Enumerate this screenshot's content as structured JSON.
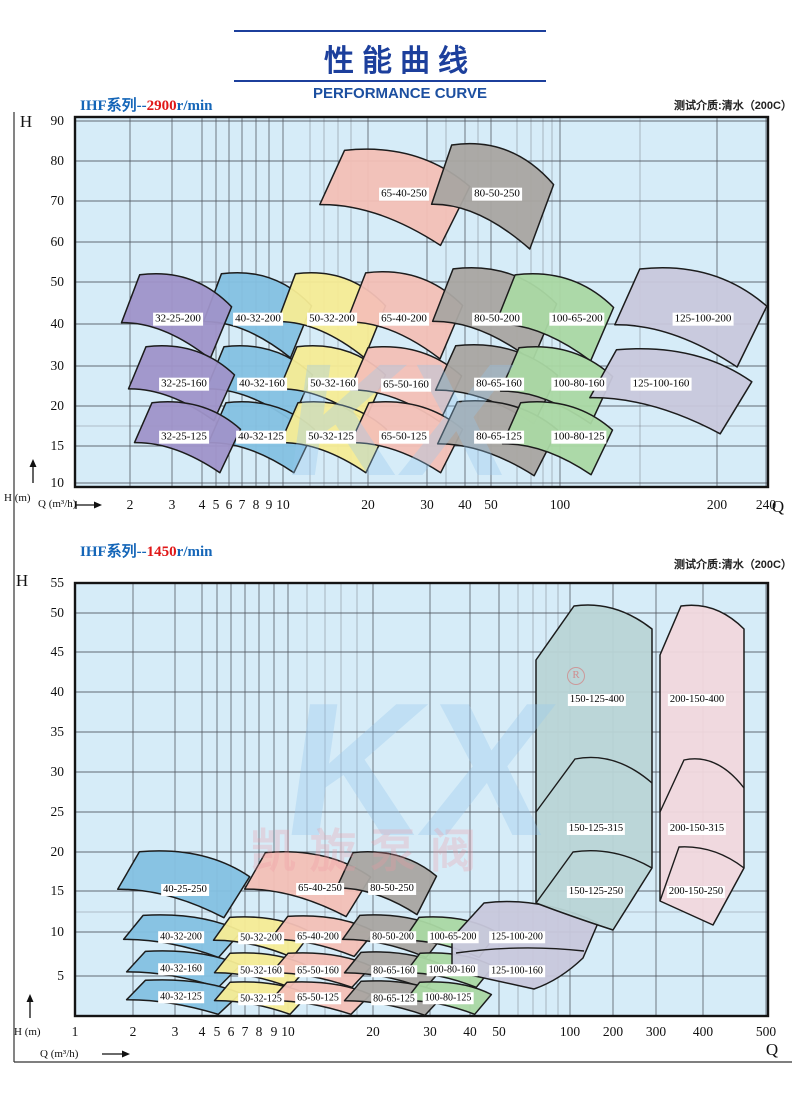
{
  "page": {
    "title_cn": "性能曲线",
    "title_en": "PERFORMANCE CURVE",
    "watermark": {
      "letters": "KX",
      "reg": "R",
      "cn": "凯旋泵阀"
    }
  },
  "colors": {
    "plot_bg": "#d6ecf8",
    "grid_major": "#50545e",
    "grid_minor": "#6a6e78",
    "plot_border": "#141414",
    "region_stroke": "#1c1c1c",
    "frame": "#333333",
    "title_blue": "#1c3f9c",
    "header_blue": "#1566b8",
    "accent_red": "#e01818",
    "palette": {
      "purple": "#9f93c9",
      "blue": "#84c1e2",
      "yellow": "#f6ec95",
      "pink": "#f3c0b6",
      "gray": "#a9a5a1",
      "green": "#aad8a3",
      "lavender": "#c8c8dc",
      "teal": "#b9d5d6",
      "rose": "#f1d8dd"
    }
  },
  "frame": {
    "left_x": 14,
    "top_y": 112,
    "bottom_y": 1062,
    "right_x": 792
  },
  "chart_data": [
    {
      "type": "area",
      "title_prefix": "IHF系列--",
      "rpm": "2900",
      "title_suffix": "r/min",
      "note": "测试介质:清水（200C）",
      "header_y": 94,
      "note_y": 97,
      "axis_y_symbol": "H",
      "axis_x_symbol": "Q",
      "y_unit": "H (m)",
      "x_unit": "Q (m³/h)",
      "x_scale": "log-stylized",
      "y_scale": "stylized",
      "x_range": [
        2,
        240
      ],
      "y_range": [
        10,
        90
      ],
      "plot": {
        "left": 75,
        "top": 117,
        "right": 768,
        "bottom": 487
      },
      "x_ticks": [
        [
          "2",
          130
        ],
        [
          "3",
          172
        ],
        [
          "4",
          202
        ],
        [
          "5",
          216
        ],
        [
          "6",
          229
        ],
        [
          "7",
          242
        ],
        [
          "8",
          256
        ],
        [
          "9",
          269
        ],
        [
          "10",
          283
        ],
        [
          "20",
          368
        ],
        [
          "30",
          427
        ],
        [
          "40",
          465
        ],
        [
          "50",
          491
        ],
        [
          "100",
          560
        ],
        [
          "200",
          717
        ],
        [
          "240",
          766
        ]
      ],
      "x_minor": [
        310,
        324,
        338,
        351,
        446,
        478,
        517,
        531,
        543,
        552,
        640
      ],
      "y_ticks": [
        [
          "90",
          121
        ],
        [
          "80",
          161
        ],
        [
          "70",
          201
        ],
        [
          "60",
          242
        ],
        [
          "50",
          282
        ],
        [
          "40",
          324
        ],
        [
          "30",
          366
        ],
        [
          "20",
          406
        ],
        [
          "15",
          446
        ],
        [
          "10",
          483
        ]
      ],
      "y_minor": [
        426
      ],
      "x_label_y": 505,
      "label_fs": 11,
      "axis_sym_h": {
        "x": 26,
        "y": 122
      },
      "axis_sym_q": {
        "x": 778,
        "y": 507
      },
      "h_unit_pos": {
        "x": 4,
        "y": 492
      },
      "q_unit_pos": {
        "x": 38,
        "y": 498
      },
      "v_arrow": {
        "x": 33,
        "y1": 483,
        "y2": 459
      },
      "h_arrow": {
        "x1": 76,
        "x2": 102,
        "y": 505,
        "tail": true
      },
      "regions": [
        {
          "label": "65-40-250",
          "color": "pink",
          "cx": 394,
          "cy": 197,
          "w": 150,
          "h": 95,
          "lx": 404,
          "ly": 194
        },
        {
          "label": "80-50-250",
          "color": "gray",
          "cx": 492,
          "cy": 196,
          "w": 122,
          "h": 104,
          "lx": 497,
          "ly": 194
        },
        {
          "label": "40-32-200",
          "color": "blue",
          "cx": 257,
          "cy": 315,
          "w": 108,
          "h": 84,
          "lx": 258,
          "ly": 319
        },
        {
          "label": "32-25-200",
          "color": "purple",
          "cx": 176,
          "cy": 316,
          "w": 110,
          "h": 84,
          "lx": 178,
          "ly": 319
        },
        {
          "label": "50-32-200",
          "color": "yellow",
          "cx": 331,
          "cy": 315,
          "w": 108,
          "h": 84,
          "lx": 332,
          "ly": 319
        },
        {
          "label": "65-40-200",
          "color": "pink",
          "cx": 404,
          "cy": 315,
          "w": 116,
          "h": 86,
          "lx": 404,
          "ly": 319
        },
        {
          "label": "80-50-200",
          "color": "gray",
          "cx": 494,
          "cy": 314,
          "w": 124,
          "h": 92,
          "lx": 497,
          "ly": 319
        },
        {
          "label": "100-65-200",
          "color": "green",
          "cx": 554,
          "cy": 317,
          "w": 118,
          "h": 86,
          "lx": 577,
          "ly": 319
        },
        {
          "label": "125-100-200",
          "color": "lavender",
          "cx": 690,
          "cy": 317,
          "w": 152,
          "h": 98,
          "lx": 703,
          "ly": 319
        },
        {
          "label": "40-32-160",
          "color": "blue",
          "cx": 259,
          "cy": 383,
          "w": 106,
          "h": 74,
          "lx": 262,
          "ly": 384
        },
        {
          "label": "32-25-160",
          "color": "purple",
          "cx": 181,
          "cy": 383,
          "w": 106,
          "h": 74,
          "lx": 184,
          "ly": 384
        },
        {
          "label": "50-32-160",
          "color": "yellow",
          "cx": 332,
          "cy": 383,
          "w": 106,
          "h": 74,
          "lx": 333,
          "ly": 384
        },
        {
          "label": "65-50-160",
          "color": "pink",
          "cx": 405,
          "cy": 384,
          "w": 112,
          "h": 74,
          "lx": 406,
          "ly": 385
        },
        {
          "label": "80-65-160",
          "color": "gray",
          "cx": 496,
          "cy": 384,
          "w": 122,
          "h": 78,
          "lx": 499,
          "ly": 384
        },
        {
          "label": "100-80-160",
          "color": "green",
          "cx": 556,
          "cy": 385,
          "w": 112,
          "h": 76,
          "lx": 579,
          "ly": 384
        },
        {
          "label": "125-100-160",
          "color": "lavender",
          "cx": 670,
          "cy": 391,
          "w": 162,
          "h": 84,
          "lx": 661,
          "ly": 384
        },
        {
          "label": "40-32-125",
          "color": "blue",
          "cx": 261,
          "cy": 437,
          "w": 106,
          "h": 70,
          "lx": 261,
          "ly": 437
        },
        {
          "label": "32-25-125",
          "color": "purple",
          "cx": 187,
          "cy": 437,
          "w": 106,
          "h": 70,
          "lx": 184,
          "ly": 437
        },
        {
          "label": "50-32-125",
          "color": "yellow",
          "cx": 333,
          "cy": 437,
          "w": 106,
          "h": 70,
          "lx": 331,
          "ly": 437
        },
        {
          "label": "65-50-125",
          "color": "pink",
          "cx": 406,
          "cy": 437,
          "w": 112,
          "h": 70,
          "lx": 404,
          "ly": 437
        },
        {
          "label": "80-65-125",
          "color": "gray",
          "cx": 497,
          "cy": 438,
          "w": 120,
          "h": 74,
          "lx": 499,
          "ly": 437
        },
        {
          "label": "100-80-125",
          "color": "green",
          "cx": 557,
          "cy": 438,
          "w": 110,
          "h": 72,
          "lx": 579,
          "ly": 437
        }
      ],
      "watermark_kx": {
        "x": 400,
        "y": 420,
        "size": 160
      }
    },
    {
      "type": "area",
      "title_prefix": "IHF系列--",
      "rpm": "1450",
      "title_suffix": "r/min",
      "note": "测试介质:清水（200C）",
      "header_y": 540,
      "note_y": 556,
      "axis_y_symbol": "H",
      "axis_x_symbol": "Q",
      "y_unit": "H (m)",
      "x_unit": "Q (m³/h)",
      "x_scale": "log-stylized",
      "y_scale": "linear",
      "x_range": [
        1,
        500
      ],
      "y_range": [
        5,
        55
      ],
      "plot": {
        "left": 75,
        "top": 583,
        "right": 768,
        "bottom": 1016
      },
      "x_ticks": [
        [
          "1",
          75
        ],
        [
          "2",
          133
        ],
        [
          "3",
          175
        ],
        [
          "4",
          202
        ],
        [
          "5",
          217
        ],
        [
          "6",
          231
        ],
        [
          "7",
          245
        ],
        [
          "8",
          259
        ],
        [
          "9",
          274
        ],
        [
          "10",
          288
        ],
        [
          "20",
          373
        ],
        [
          "30",
          430
        ],
        [
          "40",
          470
        ],
        [
          "50",
          499
        ],
        [
          "100",
          570
        ],
        [
          "200",
          613
        ],
        [
          "300",
          656
        ],
        [
          "400",
          703
        ],
        [
          "500",
          766
        ]
      ],
      "x_minor": [
        307,
        325,
        341,
        357,
        518,
        533,
        546,
        558
      ],
      "y_ticks": [
        [
          "55",
          583
        ],
        [
          "50",
          613
        ],
        [
          "45",
          652
        ],
        [
          "40",
          692
        ],
        [
          "35",
          732
        ],
        [
          "30",
          772
        ],
        [
          "25",
          812
        ],
        [
          "20",
          852
        ],
        [
          "15",
          891
        ],
        [
          "10",
          932
        ],
        [
          "5",
          976
        ]
      ],
      "y_minor": [
        912
      ],
      "x_label_y": 1032,
      "label_fs": 10,
      "axis_sym_h": {
        "x": 22,
        "y": 581
      },
      "axis_sym_q": {
        "x": 772,
        "y": 1050
      },
      "h_unit_pos": {
        "x": 14,
        "y": 1026
      },
      "q_unit_pos": {
        "x": 40,
        "y": 1048
      },
      "v_arrow": {
        "x": 30,
        "y1": 1018,
        "y2": 994
      },
      "h_arrow": {
        "x1": 102,
        "x2": 130,
        "y": 1054,
        "tail": false
      },
      "regions": [
        {
          "label": "40-25-250",
          "color": "blue",
          "cx": 183,
          "cy": 884,
          "w": 132,
          "h": 66,
          "lx": 185,
          "ly": 890,
          "fs": 10.5
        },
        {
          "label": "65-40-250",
          "color": "pink",
          "cx": 307,
          "cy": 884,
          "w": 126,
          "h": 64,
          "lx": 320,
          "ly": 889,
          "fs": 10.5
        },
        {
          "label": "80-50-250",
          "color": "gray",
          "cx": 386,
          "cy": 883,
          "w": 100,
          "h": 62,
          "lx": 392,
          "ly": 889,
          "fs": 10.5
        },
        {
          "label": "40-32-200",
          "color": "blue",
          "cx": 182,
          "cy": 936,
          "w": 118,
          "h": 42,
          "lx": 181,
          "ly": 937
        },
        {
          "label": "50-32-200",
          "color": "yellow",
          "cx": 262,
          "cy": 937,
          "w": 98,
          "h": 40,
          "lx": 261,
          "ly": 938
        },
        {
          "label": "65-40-200",
          "color": "pink",
          "cx": 322,
          "cy": 936,
          "w": 104,
          "h": 40,
          "lx": 318,
          "ly": 937
        },
        {
          "label": "80-50-200",
          "color": "gray",
          "cx": 394,
          "cy": 936,
          "w": 104,
          "h": 42,
          "lx": 393,
          "ly": 937
        },
        {
          "label": "100-65-200",
          "color": "green",
          "cx": 450,
          "cy": 937,
          "w": 94,
          "h": 40,
          "lx": 453,
          "ly": 937
        },
        {
          "label": "40-32-160",
          "color": "blue",
          "cx": 183,
          "cy": 969,
          "w": 114,
          "h": 36,
          "lx": 181,
          "ly": 969
        },
        {
          "label": "50-32-160",
          "color": "yellow",
          "cx": 261,
          "cy": 970,
          "w": 94,
          "h": 34,
          "lx": 261,
          "ly": 971
        },
        {
          "label": "65-50-160",
          "color": "pink",
          "cx": 321,
          "cy": 970,
          "w": 100,
          "h": 34,
          "lx": 318,
          "ly": 971
        },
        {
          "label": "80-65-160",
          "color": "gray",
          "cx": 394,
          "cy": 970,
          "w": 100,
          "h": 36,
          "lx": 394,
          "ly": 971
        },
        {
          "label": "100-80-160",
          "color": "green",
          "cx": 449,
          "cy": 970,
          "w": 88,
          "h": 34,
          "lx": 452,
          "ly": 970
        },
        {
          "label": "40-32-125",
          "color": "blue",
          "cx": 183,
          "cy": 997,
          "w": 114,
          "h": 34,
          "lx": 181,
          "ly": 997
        },
        {
          "label": "50-32-125",
          "color": "yellow",
          "cx": 261,
          "cy": 998,
          "w": 94,
          "h": 32,
          "lx": 261,
          "ly": 999
        },
        {
          "label": "65-50-125",
          "color": "pink",
          "cx": 320,
          "cy": 998,
          "w": 100,
          "h": 32,
          "lx": 318,
          "ly": 998
        },
        {
          "label": "80-65-125",
          "color": "gray",
          "cx": 394,
          "cy": 998,
          "w": 100,
          "h": 34,
          "lx": 394,
          "ly": 999
        },
        {
          "label": "100-80-125",
          "color": "green",
          "cx": 448,
          "cy": 998,
          "w": 86,
          "h": 32,
          "lx": 448,
          "ly": 998
        },
        {
          "color": "lavender",
          "path": "M452,938 L484,903 Q540,896 598,923 L583,958 Q560,980 534,989 L452,971 Z",
          "dividers": [
            "M456,953 Q520,944 584,951"
          ],
          "labels": [
            {
              "text": "125-100-200",
              "x": 517,
              "y": 937
            },
            {
              "text": "125-100-160",
              "x": 517,
              "y": 971
            }
          ]
        },
        {
          "color": "teal",
          "path": "M536,903 L536,660 L574,606 Q615,600 652,629 L652,868 L613,930 Q570,916 536,903 Z",
          "dividers": [
            "M536,812 L575,759 Q615,751 652,783",
            "M536,903 L573,852 Q614,846 652,868"
          ],
          "labels": [
            {
              "text": "150-125-400",
              "x": 597,
              "y": 700,
              "fs": 10.5
            },
            {
              "text": "150-125-315",
              "x": 596,
              "y": 829,
              "fs": 10.5
            },
            {
              "text": "150-125-250",
              "x": 596,
              "y": 892,
              "fs": 10.5
            }
          ]
        },
        {
          "color": "rose",
          "path": "M660,901 L660,655 L681,606 Q716,601 744,629 L744,868 L713,925 Q682,911 660,901 Z",
          "dividers": [
            "M660,812 L684,760 Q717,753 744,788",
            "M660,901 L679,847 Q714,845 744,868"
          ],
          "labels": [
            {
              "text": "200-150-400",
              "x": 697,
              "y": 700,
              "fs": 10.5
            },
            {
              "text": "200-150-315",
              "x": 697,
              "y": 829,
              "fs": 10.5
            },
            {
              "text": "200-150-250",
              "x": 696,
              "y": 892,
              "fs": 10.5
            }
          ]
        }
      ],
      "watermark_kx": {
        "x": 420,
        "y": 770,
        "size": 190
      },
      "watermark_reg": {
        "x": 576,
        "y": 676
      },
      "watermark_cn": {
        "x": 370,
        "y": 848,
        "size": 46
      }
    }
  ]
}
